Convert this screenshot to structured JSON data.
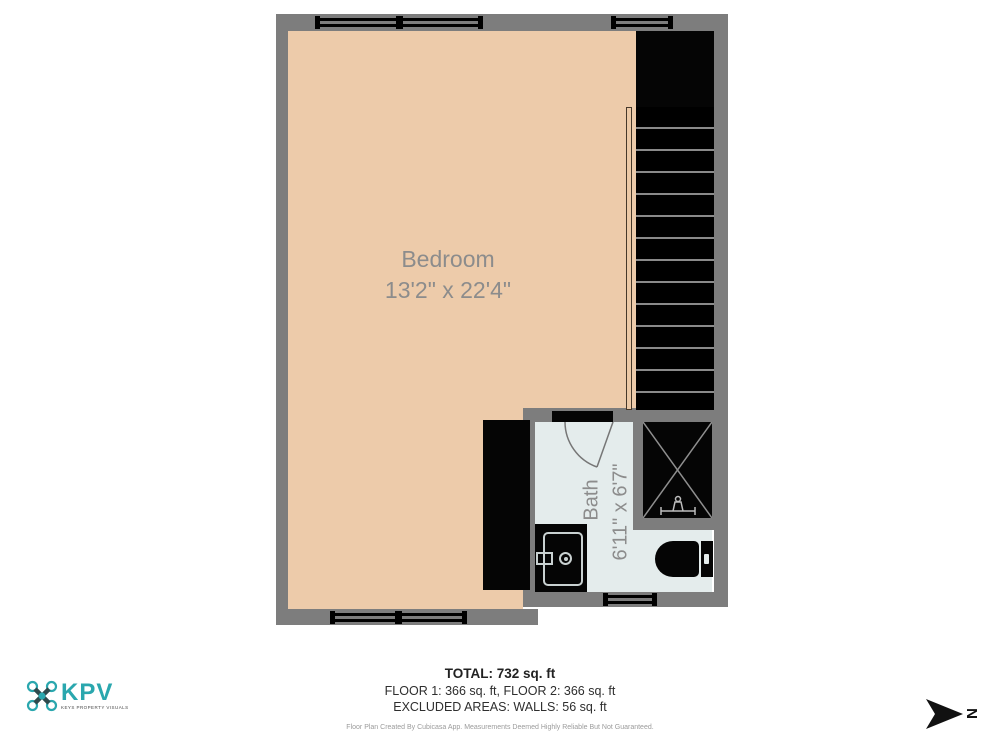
{
  "plan": {
    "colors": {
      "wall": "#7d7d7d",
      "bedroomFloor": "#edcbaa",
      "bathFloor": "#e4ecec",
      "fixtureBlack": "#050505",
      "roomLabel": "#8c8c8c",
      "brandTeal": "#2aa7ae"
    },
    "rooms": [
      {
        "name": "Bedroom",
        "dimensions": "13'2\" x 22'4\""
      },
      {
        "name": "Bath",
        "dimensions": "6'11\" x 6'7\""
      }
    ]
  },
  "summary": {
    "total": "TOTAL: 732 sq. ft",
    "floors": "FLOOR 1: 366 sq. ft, FLOOR 2: 366 sq. ft",
    "excluded": "EXCLUDED AREAS: WALLS: 56 sq. ft"
  },
  "disclaimer": "Floor Plan Created By Cubicasa App. Measurements Deemed Highly Reliable But Not Guaranteed.",
  "branding": {
    "name": "KPV",
    "tagline": "KEYS PROPERTY VISUALS"
  },
  "compass": {
    "label": "N"
  }
}
